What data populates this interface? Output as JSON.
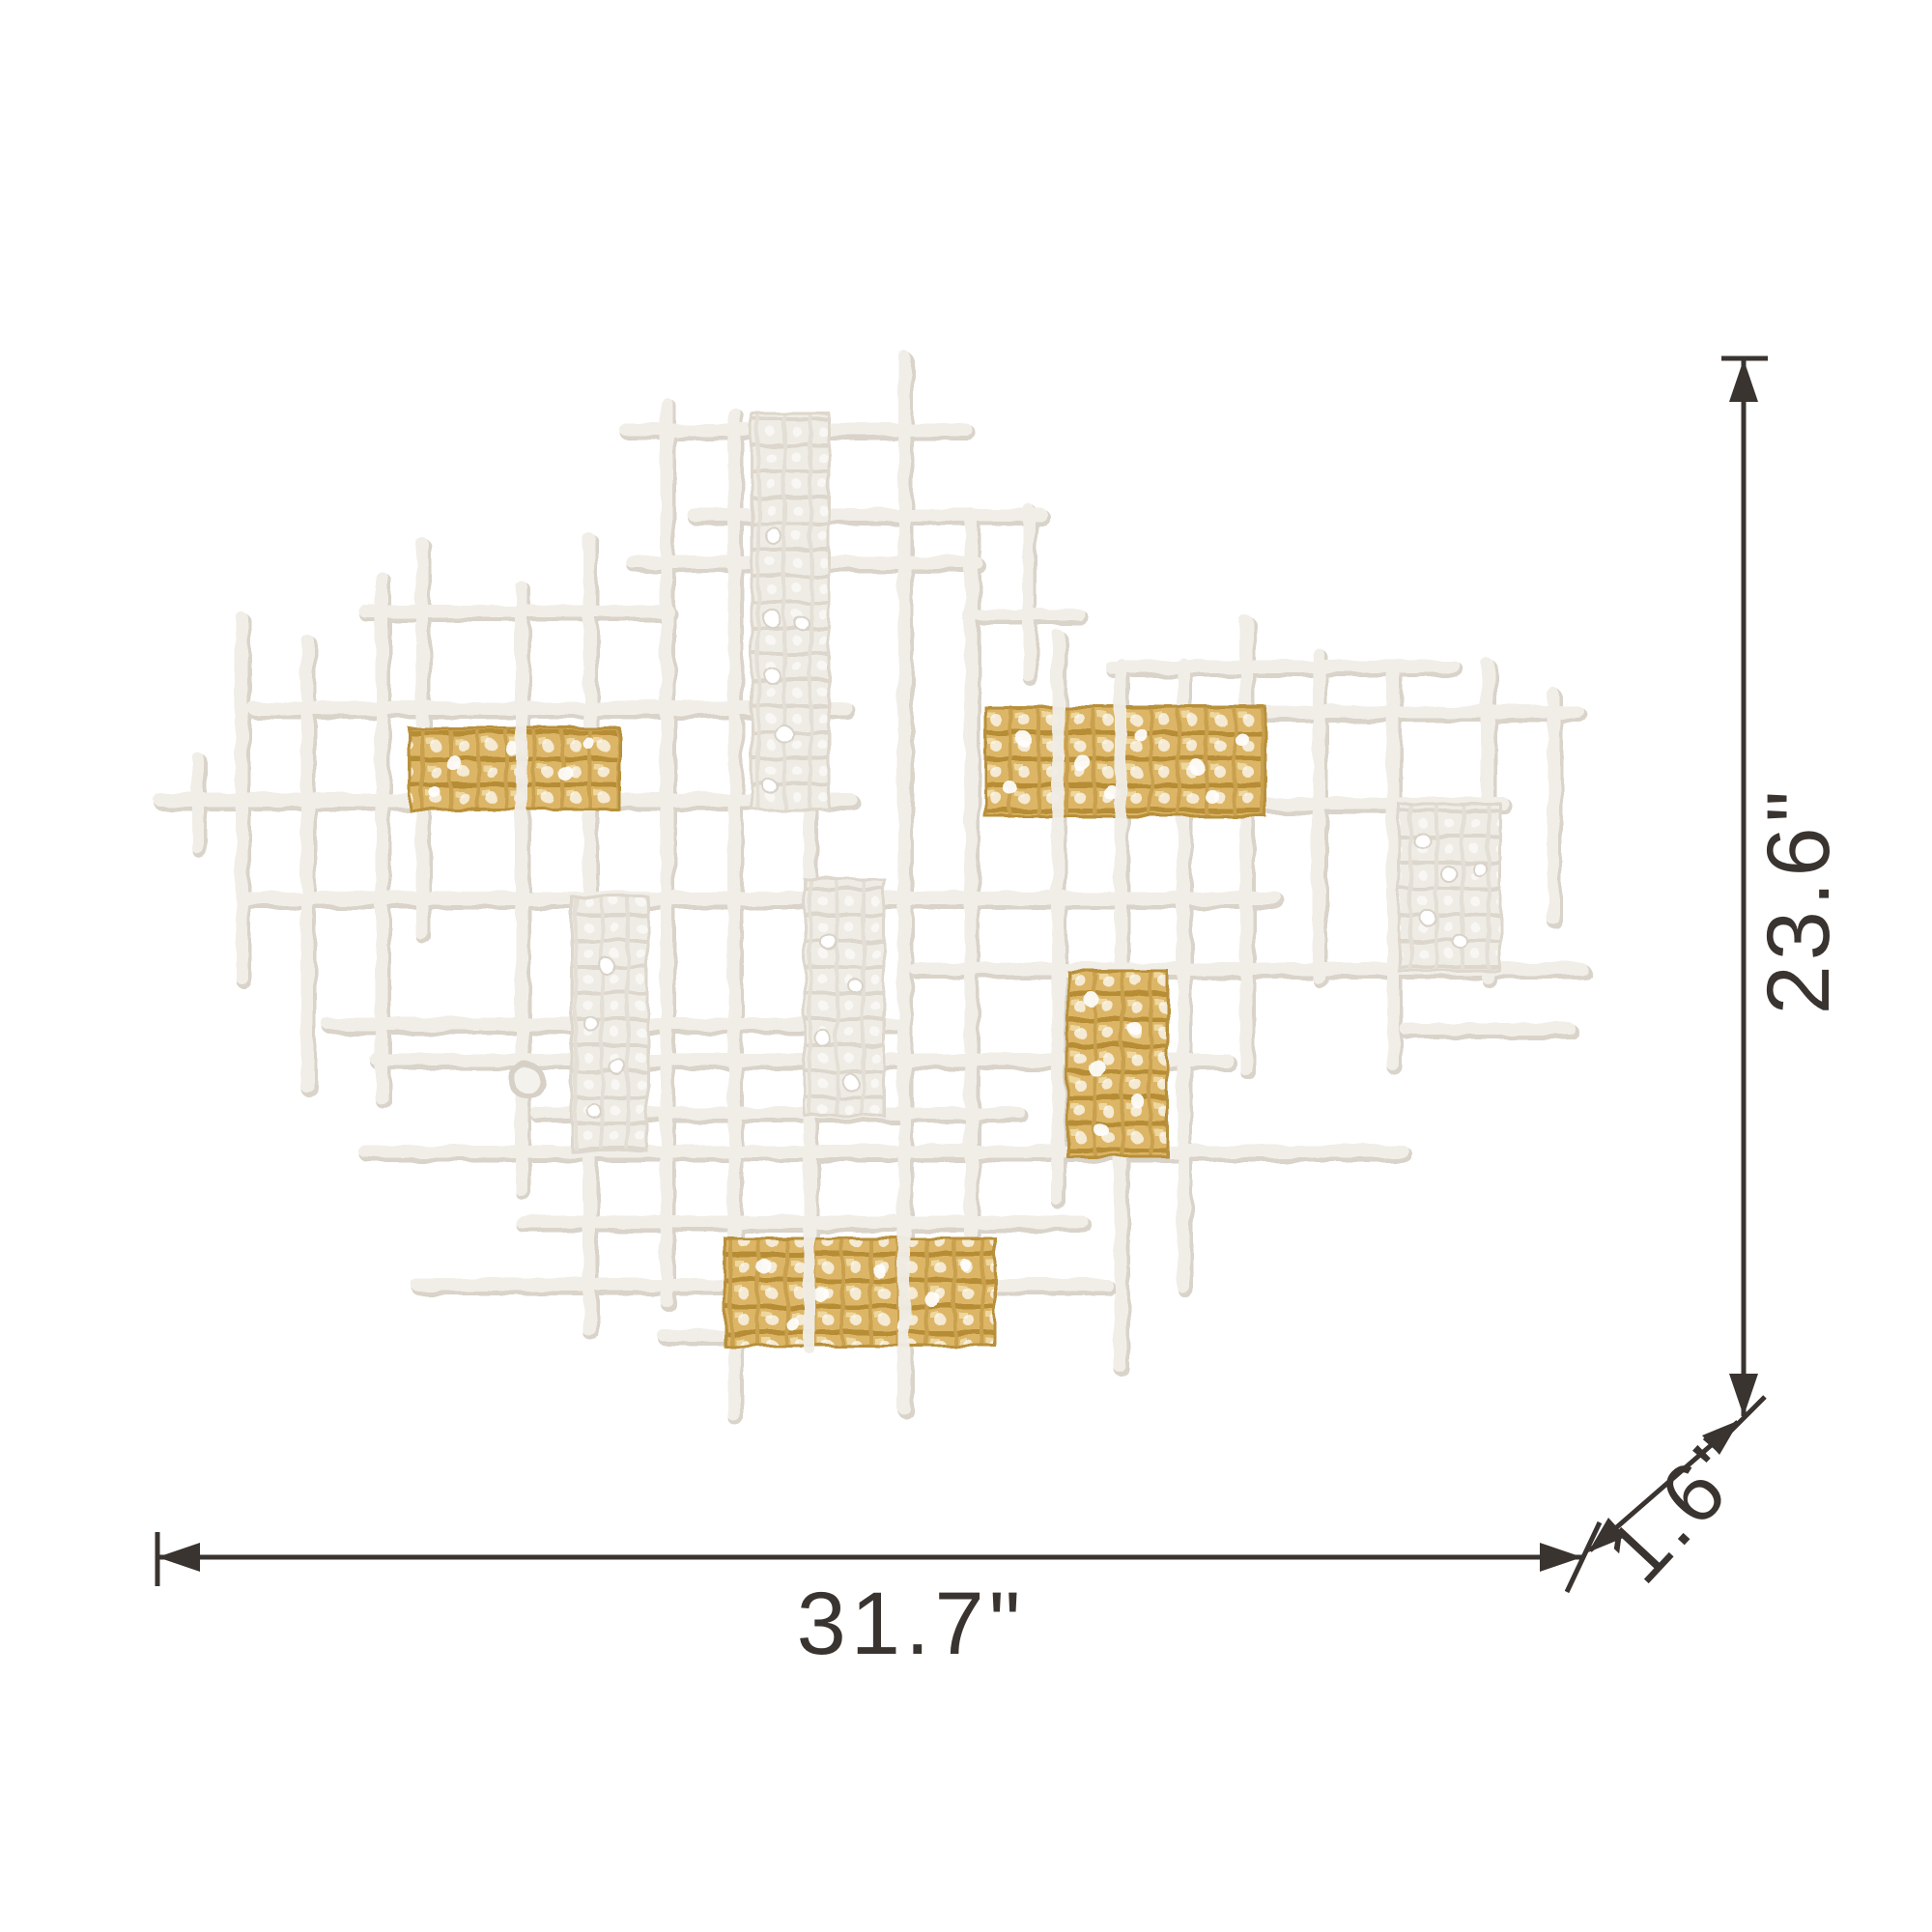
{
  "image": {
    "kind": "product dimension diagram",
    "subject": "abstract lattice grid wall sculpture in white plaster with gold woven accents"
  },
  "dimensions": {
    "width_label": "31.7\"",
    "height_label": "23.6\"",
    "depth_label": "1.6\"",
    "line_color": "#3a3431"
  },
  "artwork": {
    "colors": {
      "plaster_white": "#f1eee8",
      "plaster_shadow": "#d9d3c9",
      "weave_white": "#eeece5",
      "weave_white_line": "#dcd6cc",
      "gold": "#dcb666",
      "gold_dark": "#b68c35",
      "gold_highlight": "#f3e0ac",
      "background": "#ffffff"
    }
  }
}
